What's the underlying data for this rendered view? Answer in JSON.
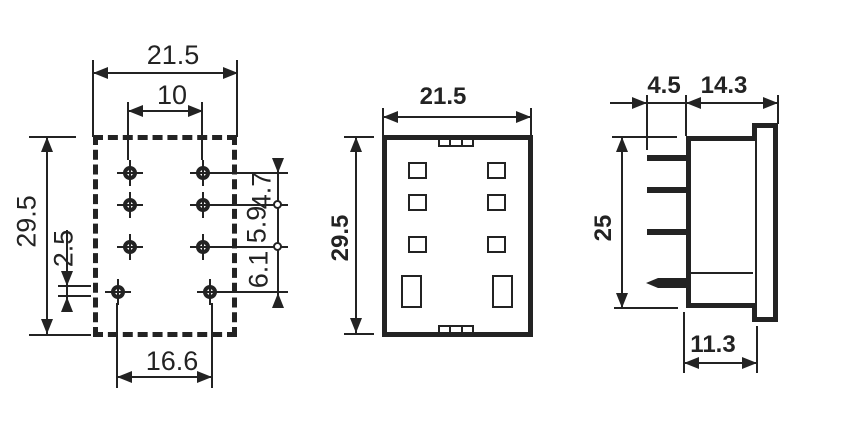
{
  "colors": {
    "line": "#232323",
    "background": "#ffffff"
  },
  "bottom_view": {
    "dim_width": "21.5",
    "dim_pin_column_span": "10",
    "dim_height": "29.5",
    "dim_pin_offset": "2.5",
    "dim_row_gap_1": "4.7",
    "dim_row_gap_2": "5.9",
    "dim_row_gap_3": "6.1",
    "dim_bottom_pin_span": "16.6"
  },
  "front_view": {
    "dim_width": "21.5",
    "dim_height": "29.5"
  },
  "side_view": {
    "dim_pin_length": "4.5",
    "dim_depth_total": "14.3",
    "dim_height": "25",
    "dim_depth_body": "11.3"
  }
}
